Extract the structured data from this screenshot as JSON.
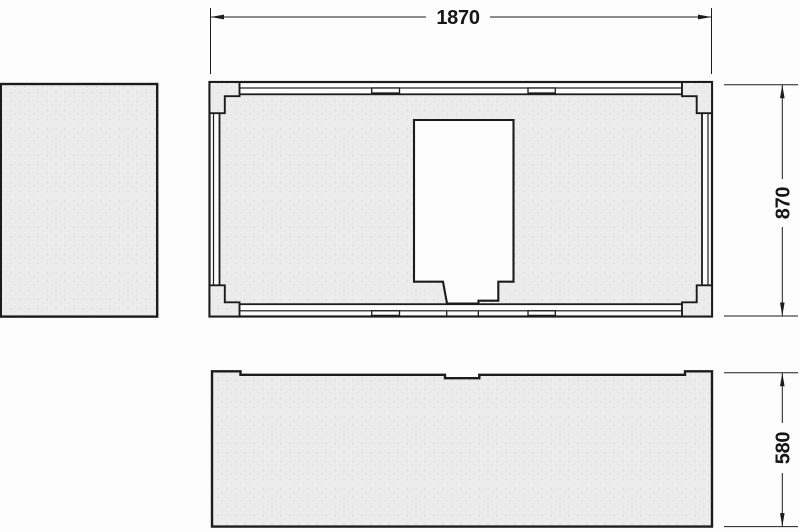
{
  "drawing": {
    "dimensions": {
      "overall_width": "1870",
      "overall_depth": "870",
      "front_height": "580"
    },
    "colors": {
      "line": "#1c1c1c",
      "panel_fill": "#ececec",
      "background": "#fdfdfd"
    }
  }
}
